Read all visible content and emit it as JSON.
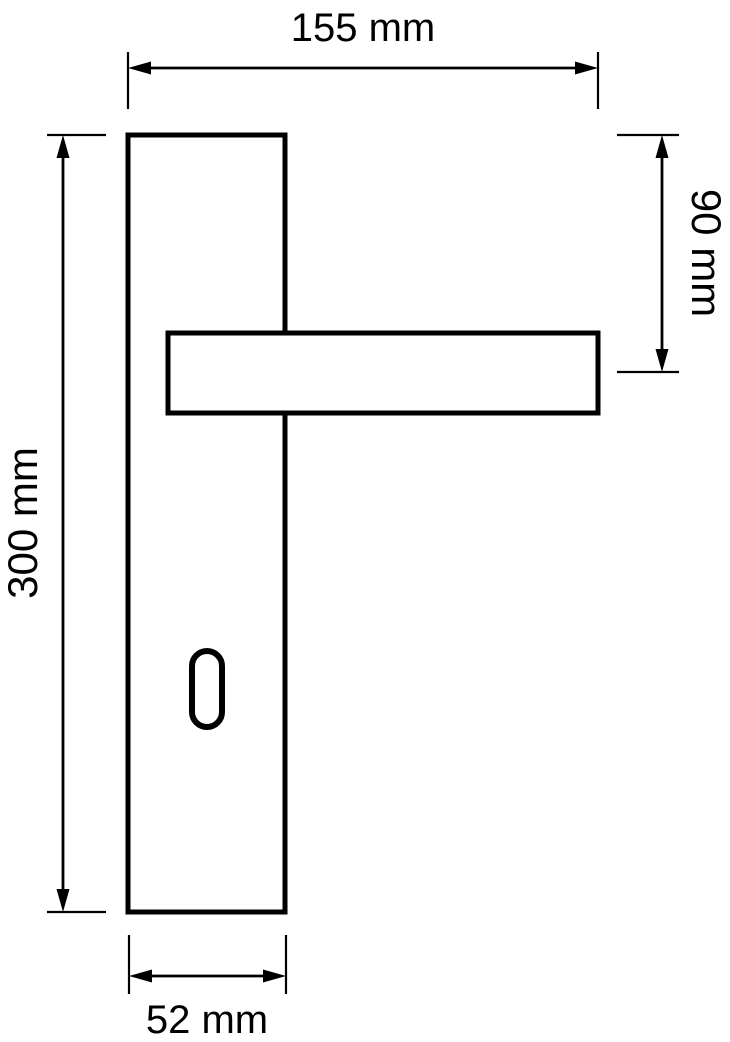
{
  "canvas": {
    "width": 730,
    "height": 1042,
    "background": "#ffffff",
    "line_color": "#000000"
  },
  "drawing": {
    "type": "technical-dimension-diagram",
    "subject": "door lever handle on long backplate with keyhole",
    "parts": [
      {
        "id": "backplate",
        "shape": "rectangle"
      },
      {
        "id": "lever-handle",
        "shape": "rectangle"
      },
      {
        "id": "keyhole",
        "shape": "stadium-slot"
      }
    ],
    "dimensions": [
      {
        "id": "overall-width",
        "label": "155 mm",
        "value": 155,
        "unit": "mm",
        "orientation": "horizontal",
        "position": "top"
      },
      {
        "id": "plate-height",
        "label": "300 mm",
        "value": 300,
        "unit": "mm",
        "orientation": "vertical",
        "position": "left"
      },
      {
        "id": "handle-axis-offset",
        "label": "90 mm",
        "value": 90,
        "unit": "mm",
        "orientation": "vertical",
        "position": "right"
      },
      {
        "id": "plate-width",
        "label": "52 mm",
        "value": 52,
        "unit": "mm",
        "orientation": "horizontal",
        "position": "bottom"
      }
    ]
  }
}
